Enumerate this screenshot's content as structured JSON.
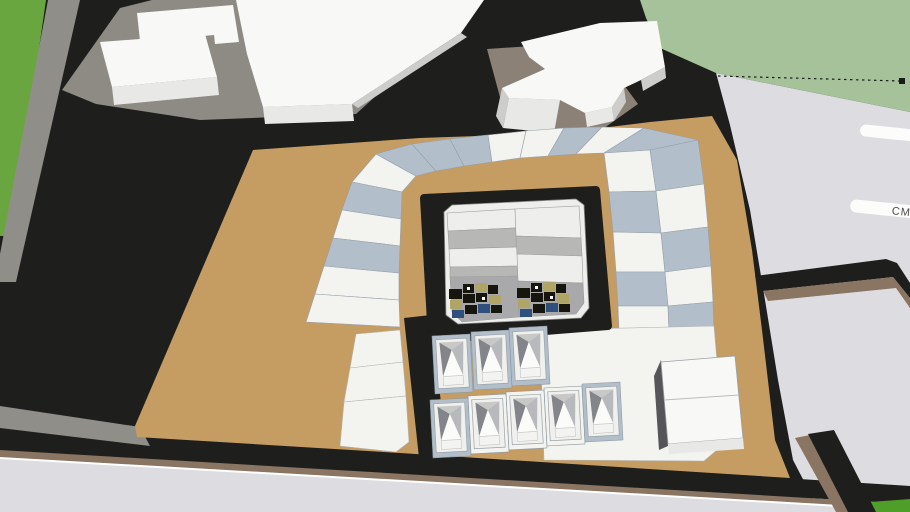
{
  "viewer": {
    "kind": "3d-model-viewport",
    "street_label_text": "CM",
    "street_label_blank": ""
  },
  "colors": {
    "ground_black": "#1e1e1c",
    "street_gray": "#dddce1",
    "white_line": "#ffffff",
    "grass_sage": "#a6c29a",
    "grass_left": "#6aa63f",
    "grass_patch": "#4f9e2a",
    "sidewalk_gray": "#908e89",
    "pad_gray": "#8e8b84",
    "pad_warm": "#8b8177",
    "tan": "#c59c62",
    "curb_brown": "#8a7462",
    "lot_white": "#f3f3f0",
    "lot_blue": "#b2bfca",
    "lot_outline": "#97a1a9",
    "building_white": "#f8f8f6",
    "building_front": "#e8e8e6",
    "building_side": "#cdcdcb",
    "courtyard_white": "#eeeeec",
    "courtyard_gray": "#b7b7b5",
    "parking_gray": "#a9a9ab",
    "roof_dark": "#84858a",
    "roof_mid": "#b8b9bc",
    "roof_back": "#c8c8c6",
    "house_white": "#fbfbf9",
    "cube_side": "#56565a",
    "car_dark": "#16160f",
    "car_khaki": "#b1a565",
    "car_blue": "#2f4f7c",
    "pill_white": "#fcfcfb",
    "label_gray": "#4f4f4f",
    "guide_line": "#1a1a1a"
  },
  "collections": {
    "horseshoe_lots": [
      {
        "n": "lot",
        "p": "352,182 376,154 416,176 402,192",
        "f": "lot_white"
      },
      {
        "n": "lot",
        "p": "376,154 412,144 436,171 416,176",
        "f": "lot_blue"
      },
      {
        "n": "lot",
        "p": "412,144 450,139 464,166 436,171",
        "f": "lot_blue"
      },
      {
        "n": "lot",
        "p": "450,139 488,135 492,162 464,166",
        "f": "lot_blue"
      },
      {
        "n": "lot",
        "p": "488,135 526,131 520,158 492,162",
        "f": "lot_white"
      },
      {
        "n": "lot",
        "p": "526,131 564,128 548,156 520,158",
        "f": "lot_white"
      },
      {
        "n": "lot",
        "p": "564,128 602,127 576,154 548,156",
        "f": "lot_blue"
      },
      {
        "n": "lot",
        "p": "602,127 644,128 604,153 576,154",
        "f": "lot_white"
      },
      {
        "n": "lot",
        "p": "644,128 698,140 650,150 604,153",
        "f": "lot_blue"
      },
      {
        "n": "lot",
        "p": "604,153 650,150 656,191 609,192",
        "f": "lot_white"
      },
      {
        "n": "lot",
        "p": "609,192 656,191 661,233 613,232",
        "f": "lot_blue"
      },
      {
        "n": "lot",
        "p": "613,232 661,233 665,272 616,272",
        "f": "lot_white"
      },
      {
        "n": "lot",
        "p": "616,272 665,272 668,306 618,306",
        "f": "lot_blue"
      },
      {
        "n": "lot",
        "p": "618,306 668,306 669,331 619,332",
        "f": "lot_white"
      },
      {
        "n": "lot",
        "p": "650,150 698,140 704,184 656,191",
        "f": "lot_blue"
      },
      {
        "n": "lot",
        "p": "656,191 704,184 708,227 661,233",
        "f": "lot_white"
      },
      {
        "n": "lot",
        "p": "661,233 708,227 711,266 665,272",
        "f": "lot_blue"
      },
      {
        "n": "lot",
        "p": "665,272 711,266 713,302 668,306",
        "f": "lot_white"
      },
      {
        "n": "lot",
        "p": "668,306 713,302 714,330 669,331",
        "f": "lot_blue"
      },
      {
        "n": "lot",
        "p": "352,182 402,192 401,219 342,210",
        "f": "lot_blue"
      },
      {
        "n": "lot",
        "p": "342,210 401,219 400,246 333,238",
        "f": "lot_white"
      },
      {
        "n": "lot",
        "p": "333,238 400,246 399,273 324,266",
        "f": "lot_blue"
      },
      {
        "n": "lot",
        "p": "324,266 399,273 399,300 315,294",
        "f": "lot_white"
      },
      {
        "n": "lot",
        "p": "315,294 399,300 400,327 306,322",
        "f": "lot_white"
      }
    ],
    "bottom_left_lots": [
      {
        "n": "lot",
        "p": "356,334 400,330 403,362 350,368",
        "f": "lot_white"
      },
      {
        "n": "lot",
        "p": "350,368 403,362 406,396 344,402",
        "f": "lot_white"
      },
      {
        "n": "lot",
        "p": "344,402 406,396 409,442 396,452 340,446",
        "f": "lot_white"
      },
      {
        "n": "lot",
        "p": "540,330 714,326 724,444 704,461 544,460",
        "f": "lot_white"
      }
    ],
    "courtyard_bands": [
      {
        "n": "band",
        "p": "447,213 515,209 516,228 448,231",
        "f": "courtyard_white"
      },
      {
        "n": "band",
        "p": "448,231 516,228 517,247 449,249",
        "f": "courtyard_gray"
      },
      {
        "n": "band",
        "p": "449,249 517,247 518,266 450,267",
        "f": "courtyard_white"
      },
      {
        "n": "band",
        "p": "450,267 518,266 518,278 450,277",
        "f": "courtyard_gray"
      },
      {
        "n": "parking",
        "p": "450,277 518,276 519,317 462,322 452,312",
        "f": "parking_gray"
      },
      {
        "n": "band",
        "p": "515,209 579,206 581,238 516,236",
        "f": "courtyard_white"
      },
      {
        "n": "band",
        "p": "516,236 581,238 582,256 517,254",
        "f": "courtyard_gray"
      },
      {
        "n": "band",
        "p": "517,254 582,256 583,283 518,281",
        "f": "courtyard_white"
      },
      {
        "n": "parking",
        "p": "518,281 583,283 584,303 576,314 519,317",
        "f": "parking_gray"
      }
    ],
    "houses": [
      {
        "x": 432,
        "y": 336,
        "rot": -3,
        "pad": "lot_blue"
      },
      {
        "x": 471,
        "y": 332,
        "rot": -3,
        "pad": "lot_blue"
      },
      {
        "x": 509,
        "y": 328,
        "rot": -3,
        "pad": "lot_blue"
      },
      {
        "x": 430,
        "y": 400,
        "rot": -3,
        "pad": "lot_blue"
      },
      {
        "x": 468,
        "y": 396,
        "rot": -3,
        "pad": "lot_white"
      },
      {
        "x": 506,
        "y": 392,
        "rot": -3,
        "pad": "lot_white"
      },
      {
        "x": 544,
        "y": 388,
        "rot": -3,
        "pad": "lot_white"
      },
      {
        "x": 582,
        "y": 384,
        "rot": -3,
        "pad": "lot_blue"
      }
    ],
    "car_clusters": [
      {
        "x": 449,
        "y": 282
      },
      {
        "x": 517,
        "y": 281
      }
    ]
  }
}
